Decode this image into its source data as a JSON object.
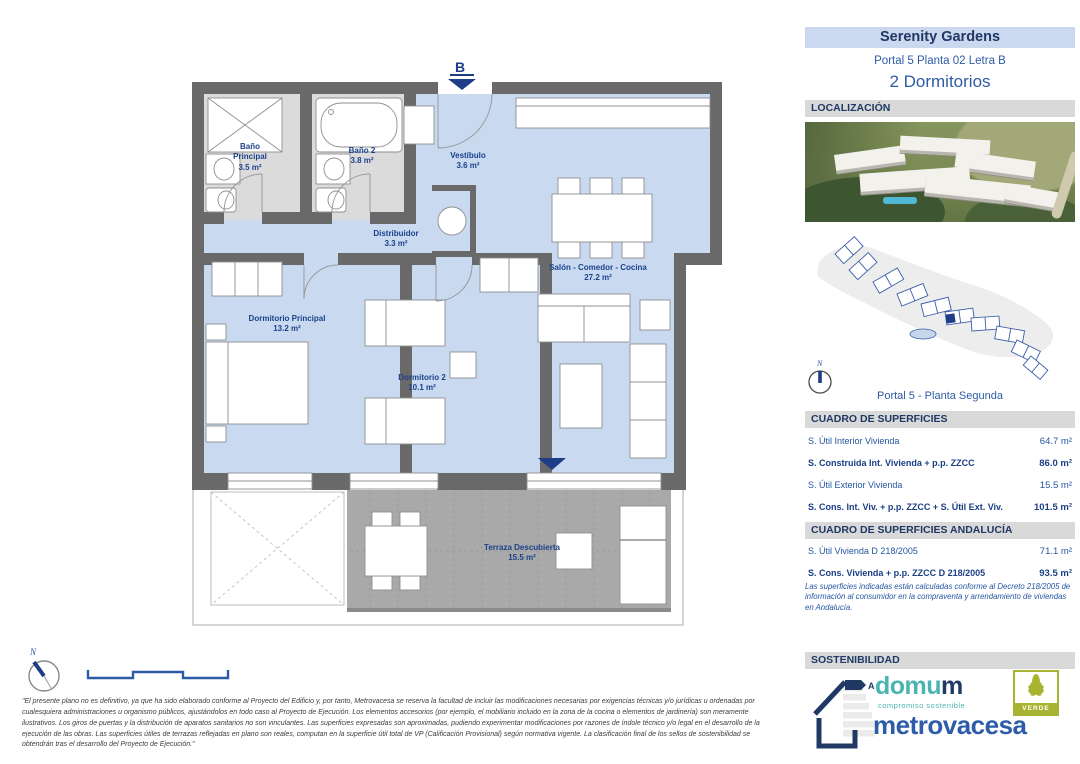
{
  "sidebar": {
    "title": "Serenity Gardens",
    "subtitle": "Portal 5 Planta 02 Letra B",
    "bedrooms": "2 Dormitorios",
    "localizacion_header": "LOCALIZACIÓN",
    "siteplan_caption": "Portal 5 - Planta Segunda",
    "compass_label": "N",
    "surfaces": {
      "header": "CUADRO DE SUPERFICIES",
      "rows": [
        {
          "label": "S. Útil Interior Vivienda",
          "value": "64.7 m²"
        },
        {
          "label": "S. Construida Int. Vivienda + p.p. ZZCC",
          "value": "86.0 m²"
        },
        {
          "label": "S. Útil Exterior Vivienda",
          "value": "15.5 m²"
        },
        {
          "label": "S. Cons. Int. Viv. + p.p. ZZCC + S. Útil Ext. Viv.",
          "value": "101.5 m²"
        }
      ]
    },
    "surfaces_andalucia": {
      "header": "CUADRO DE SUPERFICIES ANDALUCÍA",
      "rows": [
        {
          "label": "S. Útil Vivienda D 218/2005",
          "value": "71.1 m²"
        },
        {
          "label": "S. Cons. Vivienda + p.p. ZZCC D 218/2005",
          "value": "93.5 m²"
        }
      ],
      "note": "Las superficies indicadas están calculadas conforme al Decreto 218/2005 de información al consumidor en la compraventa y arrendamiento de viviendas en Andalucía."
    },
    "sostenibilidad": {
      "header": "SOSTENIBILIDAD",
      "energy_rating": "A",
      "domum_first": "domu",
      "domum_last": "m",
      "domum_tagline": "compromiso sostenible",
      "metrovacesa": "metrovacesa",
      "verde": "VERDE"
    }
  },
  "floor_plan": {
    "entrance_label": "B",
    "compass_label": "N",
    "rooms": [
      {
        "name": "Baño Principal",
        "area": "3.5 m²"
      },
      {
        "name": "Baño 2",
        "area": "3.8 m²"
      },
      {
        "name": "Vestíbulo",
        "area": "3.6 m²"
      },
      {
        "name": "Distribuidor",
        "area": "3.3 m²"
      },
      {
        "name": "Salón - Comedor - Cocina",
        "area": "27.2 m²"
      },
      {
        "name": "Dormitorio Principal",
        "area": "13.2 m²"
      },
      {
        "name": "Dormitorio 2",
        "area": "10.1 m²"
      },
      {
        "name": "Terraza Descubierta",
        "area": "15.5 m²"
      }
    ]
  },
  "disclaimer": "\"El presente plano no es definitivo, ya que ha sido elaborado conforme al Proyecto del Edificio y, por tanto, Metrovacesa se reserva la facultad de incluir las modificaciones necesarias por exigencias técnicas y/o jurídicas u ordenadas por cualesquiera administraciones u organismo públicos, ajustándolos en todo caso al Proyecto de Ejecución. Los elementos accesorios (por ejemplo, el mobiliario incluido en la zona de la cocina o elementos de jardinería) son meramente ilustrativos. Los giros de puertas y la distribución de aparatos sanitarios no son vinculantes. Las superficies expresadas son aproximadas, pudiendo experimentar modificaciones por razones de índole técnico y/o legal en el desarrollo de la ejecución de las obras. Las superficies útiles de terrazas reflejadas en plano son reales, computan en la superficie útil total de VP (Calificación Provisional) según normativa vigente. La clasificación final de los sellos de sostenibilidad se obtendrán tras el desarrollo del Proyecto de Ejecución.\""
}
